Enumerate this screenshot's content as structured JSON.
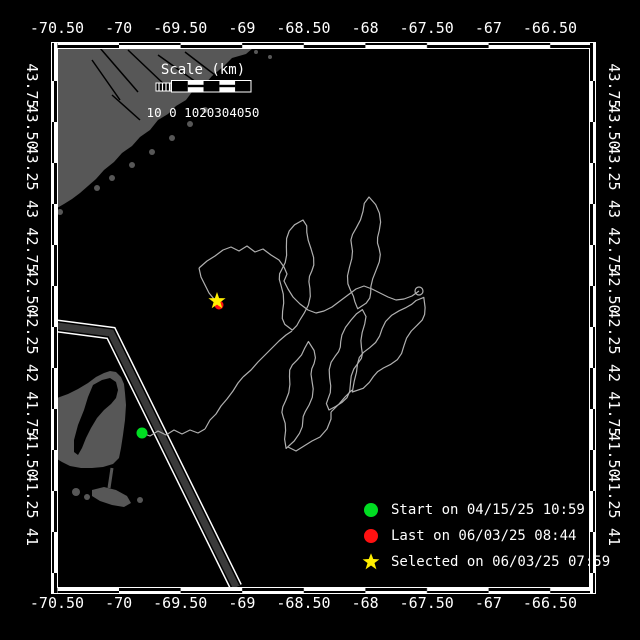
{
  "window": {
    "title": "Drifter track map"
  },
  "axes": {
    "top_labels": [
      "-70.50",
      "-70",
      "-69.50",
      "-69",
      "-68.50",
      "-68",
      "-67.50",
      "-67",
      "-66.50"
    ],
    "bottom_labels": [
      "-70.50",
      "-70",
      "-69.50",
      "-69",
      "-68.50",
      "-68",
      "-67.50",
      "-67",
      "-66.50"
    ],
    "left_labels": [
      "43.75",
      "43.50",
      "43.25",
      "43",
      "42.75",
      "42.50",
      "42.25",
      "42",
      "41.75",
      "41.50",
      "41.25",
      "41"
    ],
    "right_labels": [
      "43.75",
      "43.50",
      "43.25",
      "43",
      "42.75",
      "42.50",
      "42.25",
      "42",
      "41.75",
      "41.50",
      "41.25",
      "41"
    ],
    "lon_values": [
      -70.5,
      -70,
      -69.5,
      -69,
      -68.5,
      -68,
      -67.5,
      -67,
      -66.5
    ],
    "lat_values": [
      43.75,
      43.5,
      43.25,
      43,
      42.75,
      42.5,
      42.25,
      42,
      41.75,
      41.5,
      41.25,
      41
    ]
  },
  "scalebar": {
    "title": "Scale (km)",
    "tick_label": "10 0 1020304050"
  },
  "legend": {
    "items": [
      {
        "marker": "circle",
        "color": "#00dd22",
        "label": "Start on 04/15/25 10:59"
      },
      {
        "marker": "circle",
        "color": "#ff1111",
        "label": "Last on 06/03/25 08:44"
      },
      {
        "marker": "star",
        "color": "#ffee00",
        "label": "Selected on 06/03/25 07:59"
      }
    ]
  },
  "colors": {
    "background": "#000000",
    "frame": "#ffffff",
    "land": "#575757",
    "track": "#b0b0b0",
    "lane_core": "#3a3a3a",
    "start": "#00dd22",
    "last": "#ff1111",
    "selected": "#ffee00"
  },
  "map": {
    "markers": {
      "start": {
        "x": 142,
        "y": 433
      },
      "last": {
        "x": 219,
        "y": 305
      },
      "selected": {
        "x": 217,
        "y": 301
      }
    },
    "track": {
      "loops": [
        {
          "x1": 292,
          "y1": 331,
          "x2": 301,
          "y2": 220,
          "w": 15
        },
        {
          "x1": 358,
          "y1": 311,
          "x2": 371,
          "y2": 199,
          "w": 14
        },
        {
          "x1": 352,
          "y1": 390,
          "x2": 426,
          "y2": 296,
          "w": 14
        },
        {
          "x1": 331,
          "y1": 412,
          "x2": 361,
          "y2": 311,
          "w": 12
        },
        {
          "x1": 288,
          "y1": 447,
          "x2": 309,
          "y2": 341,
          "w": 12
        }
      ],
      "knot": {
        "x": 419,
        "y": 291,
        "r": 4
      },
      "connectors": [
        [
          [
            142,
            433
          ],
          [
            150,
            436
          ],
          [
            158,
            431
          ],
          [
            166,
            435
          ],
          [
            174,
            430
          ],
          [
            182,
            434
          ],
          [
            190,
            430
          ],
          [
            198,
            433
          ],
          [
            205,
            429
          ]
        ],
        [
          [
            205,
            429
          ],
          [
            210,
            420
          ],
          [
            216,
            414
          ],
          [
            221,
            406
          ],
          [
            227,
            399
          ],
          [
            233,
            391
          ],
          [
            238,
            383
          ],
          [
            243,
            377
          ]
        ],
        [
          [
            243,
            377
          ],
          [
            251,
            370
          ],
          [
            258,
            362
          ],
          [
            265,
            355
          ],
          [
            272,
            348
          ],
          [
            279,
            341
          ],
          [
            286,
            335
          ],
          [
            292,
            331
          ]
        ],
        [
          [
            199,
            268
          ],
          [
            207,
            261
          ],
          [
            215,
            256
          ],
          [
            223,
            250
          ],
          [
            231,
            247
          ],
          [
            239,
            251
          ],
          [
            247,
            246
          ],
          [
            255,
            252
          ],
          [
            263,
            249
          ],
          [
            271,
            255
          ],
          [
            279,
            260
          ],
          [
            284,
            267
          ],
          [
            287,
            274
          ],
          [
            284,
            281
          ],
          [
            288,
            289
          ],
          [
            293,
            297
          ],
          [
            300,
            304
          ],
          [
            308,
            310
          ],
          [
            316,
            313
          ],
          [
            324,
            311
          ],
          [
            332,
            307
          ],
          [
            340,
            301
          ],
          [
            348,
            295
          ],
          [
            356,
            289
          ],
          [
            364,
            286
          ],
          [
            372,
            289
          ],
          [
            380,
            293
          ],
          [
            388,
            297
          ],
          [
            396,
            300
          ],
          [
            404,
            299
          ],
          [
            412,
            296
          ],
          [
            419,
            291
          ]
        ],
        [
          [
            199,
            268
          ],
          [
            201,
            277
          ],
          [
            205,
            285
          ],
          [
            209,
            293
          ],
          [
            214,
            299
          ],
          [
            217,
            303
          ]
        ],
        [
          [
            288,
            447
          ],
          [
            296,
            451
          ],
          [
            304,
            446
          ],
          [
            312,
            441
          ],
          [
            320,
            437
          ],
          [
            327,
            429
          ],
          [
            331,
            419
          ],
          [
            331,
            412
          ]
        ],
        [
          [
            331,
            412
          ],
          [
            339,
            404
          ],
          [
            345,
            397
          ],
          [
            352,
            390
          ]
        ]
      ]
    },
    "lane": [
      [
        57,
        326
      ],
      [
        111,
        333
      ],
      [
        236,
        587
      ]
    ],
    "land": {
      "maine": [
        [
          57,
          48
        ],
        [
          253,
          48
        ],
        [
          246,
          54
        ],
        [
          232,
          58
        ],
        [
          224,
          66
        ],
        [
          212,
          76
        ],
        [
          205,
          84
        ],
        [
          192,
          92
        ],
        [
          186,
          100
        ],
        [
          176,
          106
        ],
        [
          168,
          114
        ],
        [
          158,
          120
        ],
        [
          150,
          130
        ],
        [
          140,
          137
        ],
        [
          132,
          146
        ],
        [
          122,
          153
        ],
        [
          114,
          162
        ],
        [
          104,
          170
        ],
        [
          96,
          179
        ],
        [
          88,
          186
        ],
        [
          80,
          193
        ],
        [
          72,
          199
        ],
        [
          64,
          204
        ],
        [
          57,
          208
        ]
      ],
      "cape_body": [
        [
          57,
          398
        ],
        [
          68,
          394
        ],
        [
          78,
          389
        ],
        [
          88,
          383
        ],
        [
          96,
          377
        ],
        [
          104,
          373
        ],
        [
          110,
          371
        ],
        [
          116,
          372
        ],
        [
          121,
          377
        ],
        [
          124,
          384
        ],
        [
          125,
          393
        ],
        [
          126,
          405
        ],
        [
          125,
          420
        ],
        [
          123,
          435
        ],
        [
          121,
          448
        ],
        [
          119,
          458
        ],
        [
          113,
          464
        ],
        [
          103,
          467
        ],
        [
          92,
          468
        ],
        [
          81,
          468
        ],
        [
          70,
          466
        ],
        [
          62,
          462
        ],
        [
          57,
          459
        ]
      ],
      "cape_bay": [
        [
          93,
          385
        ],
        [
          102,
          380
        ],
        [
          110,
          378
        ],
        [
          116,
          382
        ],
        [
          118,
          390
        ],
        [
          116,
          398
        ],
        [
          111,
          404
        ],
        [
          104,
          410
        ],
        [
          97,
          418
        ],
        [
          91,
          428
        ],
        [
          86,
          438
        ],
        [
          82,
          448
        ],
        [
          78,
          455
        ],
        [
          74,
          452
        ],
        [
          74,
          440
        ],
        [
          78,
          425
        ],
        [
          84,
          410
        ],
        [
          88,
          397
        ]
      ],
      "south_arm": [
        [
          92,
          490
        ],
        [
          104,
          487
        ],
        [
          116,
          490
        ],
        [
          127,
          496
        ],
        [
          131,
          503
        ],
        [
          124,
          507
        ],
        [
          112,
          505
        ],
        [
          100,
          501
        ],
        [
          92,
          496
        ]
      ],
      "islands": [
        [
          97,
          188,
          3
        ],
        [
          112,
          178,
          3
        ],
        [
          132,
          165,
          3
        ],
        [
          152,
          152,
          3
        ],
        [
          172,
          138,
          3
        ],
        [
          190,
          124,
          3
        ],
        [
          205,
          110,
          3
        ],
        [
          60,
          212,
          3
        ],
        [
          256,
          52,
          2
        ],
        [
          264,
          47,
          2
        ],
        [
          270,
          57,
          2
        ],
        [
          76,
          492,
          4
        ],
        [
          87,
          497,
          3
        ],
        [
          140,
          500,
          3
        ]
      ],
      "rivers": [
        [
          [
            100,
            48
          ],
          [
            138,
            92
          ]
        ],
        [
          [
            128,
            50
          ],
          [
            168,
            88
          ]
        ],
        [
          [
            158,
            55
          ],
          [
            196,
            82
          ]
        ],
        [
          [
            185,
            52
          ],
          [
            215,
            75
          ]
        ],
        [
          [
            92,
            60
          ],
          [
            120,
            100
          ]
        ],
        [
          [
            112,
            95
          ],
          [
            140,
            120
          ]
        ]
      ],
      "spit": [
        [
          112,
          468
        ],
        [
          109,
          488
        ]
      ]
    }
  }
}
